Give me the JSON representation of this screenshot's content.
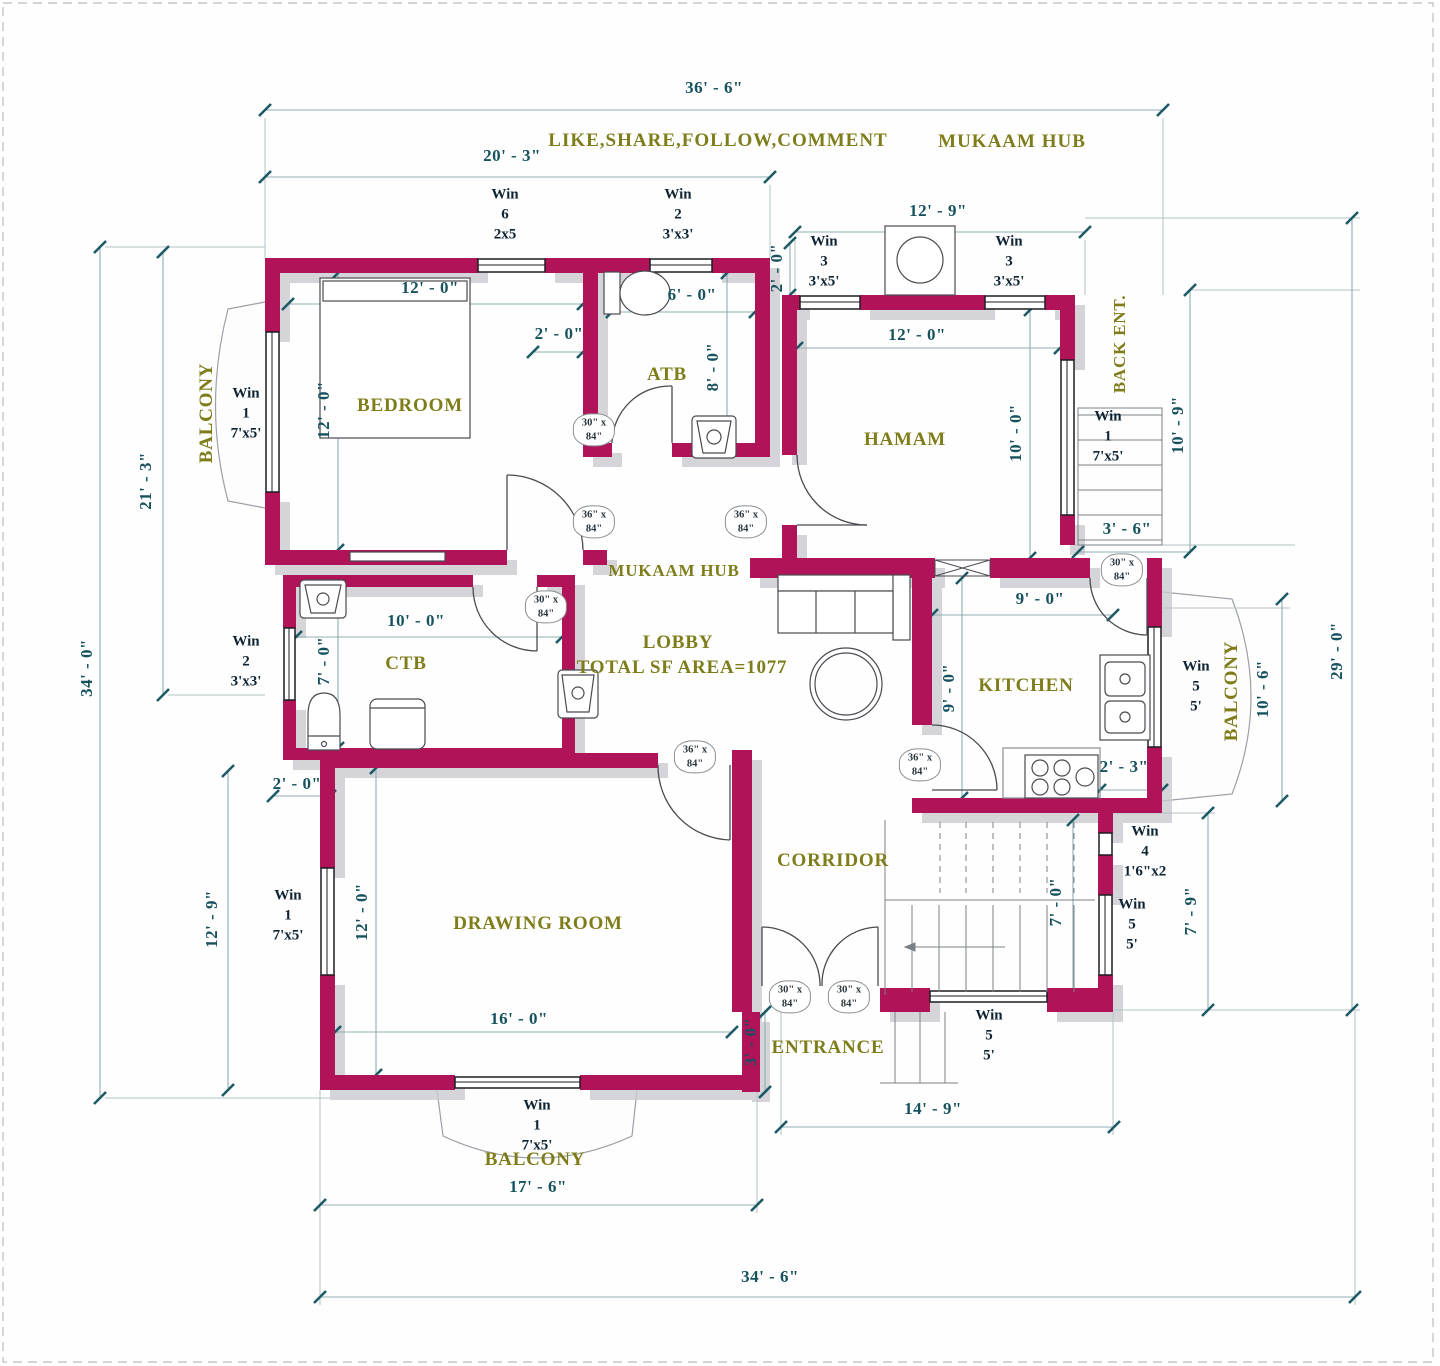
{
  "branding": {
    "social_banner": "LIKE,SHARE,FOLLOW,COMMENT",
    "brand": "MUKAAM HUB"
  },
  "rooms": {
    "balcony_left": "BALCONY",
    "balcony_right": "BALCONY",
    "balcony_bottom": "BALCONY",
    "bedroom": "BEDROOM",
    "atb": "ATB",
    "hamam": "HAMAM",
    "back_ent": "BACK ENT.",
    "mukaam_hub_mid": "MUKAAM HUB",
    "ctb": "CTB",
    "lobby": "LOBBY",
    "lobby_area": "TOTAL SF AREA=1077",
    "kitchen": "KITCHEN",
    "drawing_room": "DRAWING ROOM",
    "corridor": "CORRIDOR",
    "entrance": "ENTRANCE"
  },
  "windows": {
    "win6": {
      "name": "Win",
      "num": "6",
      "size": "2x5"
    },
    "win2_top": {
      "name": "Win",
      "num": "2",
      "size": "3'x3'"
    },
    "win3_a": {
      "name": "Win",
      "num": "3",
      "size": "3'x5'"
    },
    "win3_b": {
      "name": "Win",
      "num": "3",
      "size": "3'x5'"
    },
    "win1_balcony": {
      "name": "Win",
      "num": "1",
      "size": "7'x5'"
    },
    "win1_backent": {
      "name": "Win",
      "num": "1",
      "size": "7'x5'"
    },
    "win2_ctb": {
      "name": "Win",
      "num": "2",
      "size": "3'x3'"
    },
    "win5_kitchen": {
      "name": "Win",
      "num": "5",
      "size": "5'"
    },
    "win4": {
      "name": "Win",
      "num": "4",
      "size": "1'6\"x2"
    },
    "win5_right": {
      "name": "Win",
      "num": "5",
      "size": "5'"
    },
    "win1_drawing": {
      "name": "Win",
      "num": "1",
      "size": "7'x5'"
    },
    "win5_bottom": {
      "name": "Win",
      "num": "5",
      "size": "5'"
    },
    "win1_bottom": {
      "name": "Win",
      "num": "1",
      "size": "7'x5'"
    }
  },
  "doors": {
    "size30": {
      "l1": "30\" x",
      "l2": "84\""
    },
    "size36": {
      "l1": "36\" x",
      "l2": "84\""
    }
  },
  "dimensions": {
    "top_total": "36' - 6\"",
    "top_left": "20' - 3\"",
    "top_right": "12' - 9\"",
    "left_total": "34' - 0\"",
    "left_upper": "21' - 3\"",
    "left_lower": "12' - 9\"",
    "bedroom_w": "12' - 0\"",
    "bedroom_h": "12' - 0\"",
    "bed_atb_gap": "2' - 0\"",
    "atb_w": "6' - 0\"",
    "atb_h": "8' - 0\"",
    "hamam_gap": "2' - 0\"",
    "hamam_w": "12' - 0\"",
    "hamam_h": "10' - 0\"",
    "backent_h": "10' - 9\"",
    "right_3_6": "3' - 6\"",
    "hamam_9": "9' - 0\"",
    "kitchen_9": "9' - 0\"",
    "kitchen_2_3": "2' - 3\"",
    "right_total": "29' - 0\"",
    "balcony_right_h": "10' - 6\"",
    "ctb_w": "10' - 0\"",
    "ctb_h": "7' - 0\"",
    "jog_2_0": "2' - 0\"",
    "drawing_h": "12' - 0\"",
    "drawing_w": "16' - 0\"",
    "stair_h": "7' - 0\"",
    "entrance_h": "3' - 0\"",
    "right_7_9": "7' - 9\"",
    "bottom_14_9": "14' - 9\"",
    "bottom_17_6": "17' - 6\"",
    "bottom_34_6": "34' - 6\""
  },
  "colors": {
    "wall": "#b01357",
    "shadow": "#cbcbd0",
    "dim_text": "#16525e",
    "room_text": "#7e7d1a",
    "window_text": "#0e2433"
  }
}
